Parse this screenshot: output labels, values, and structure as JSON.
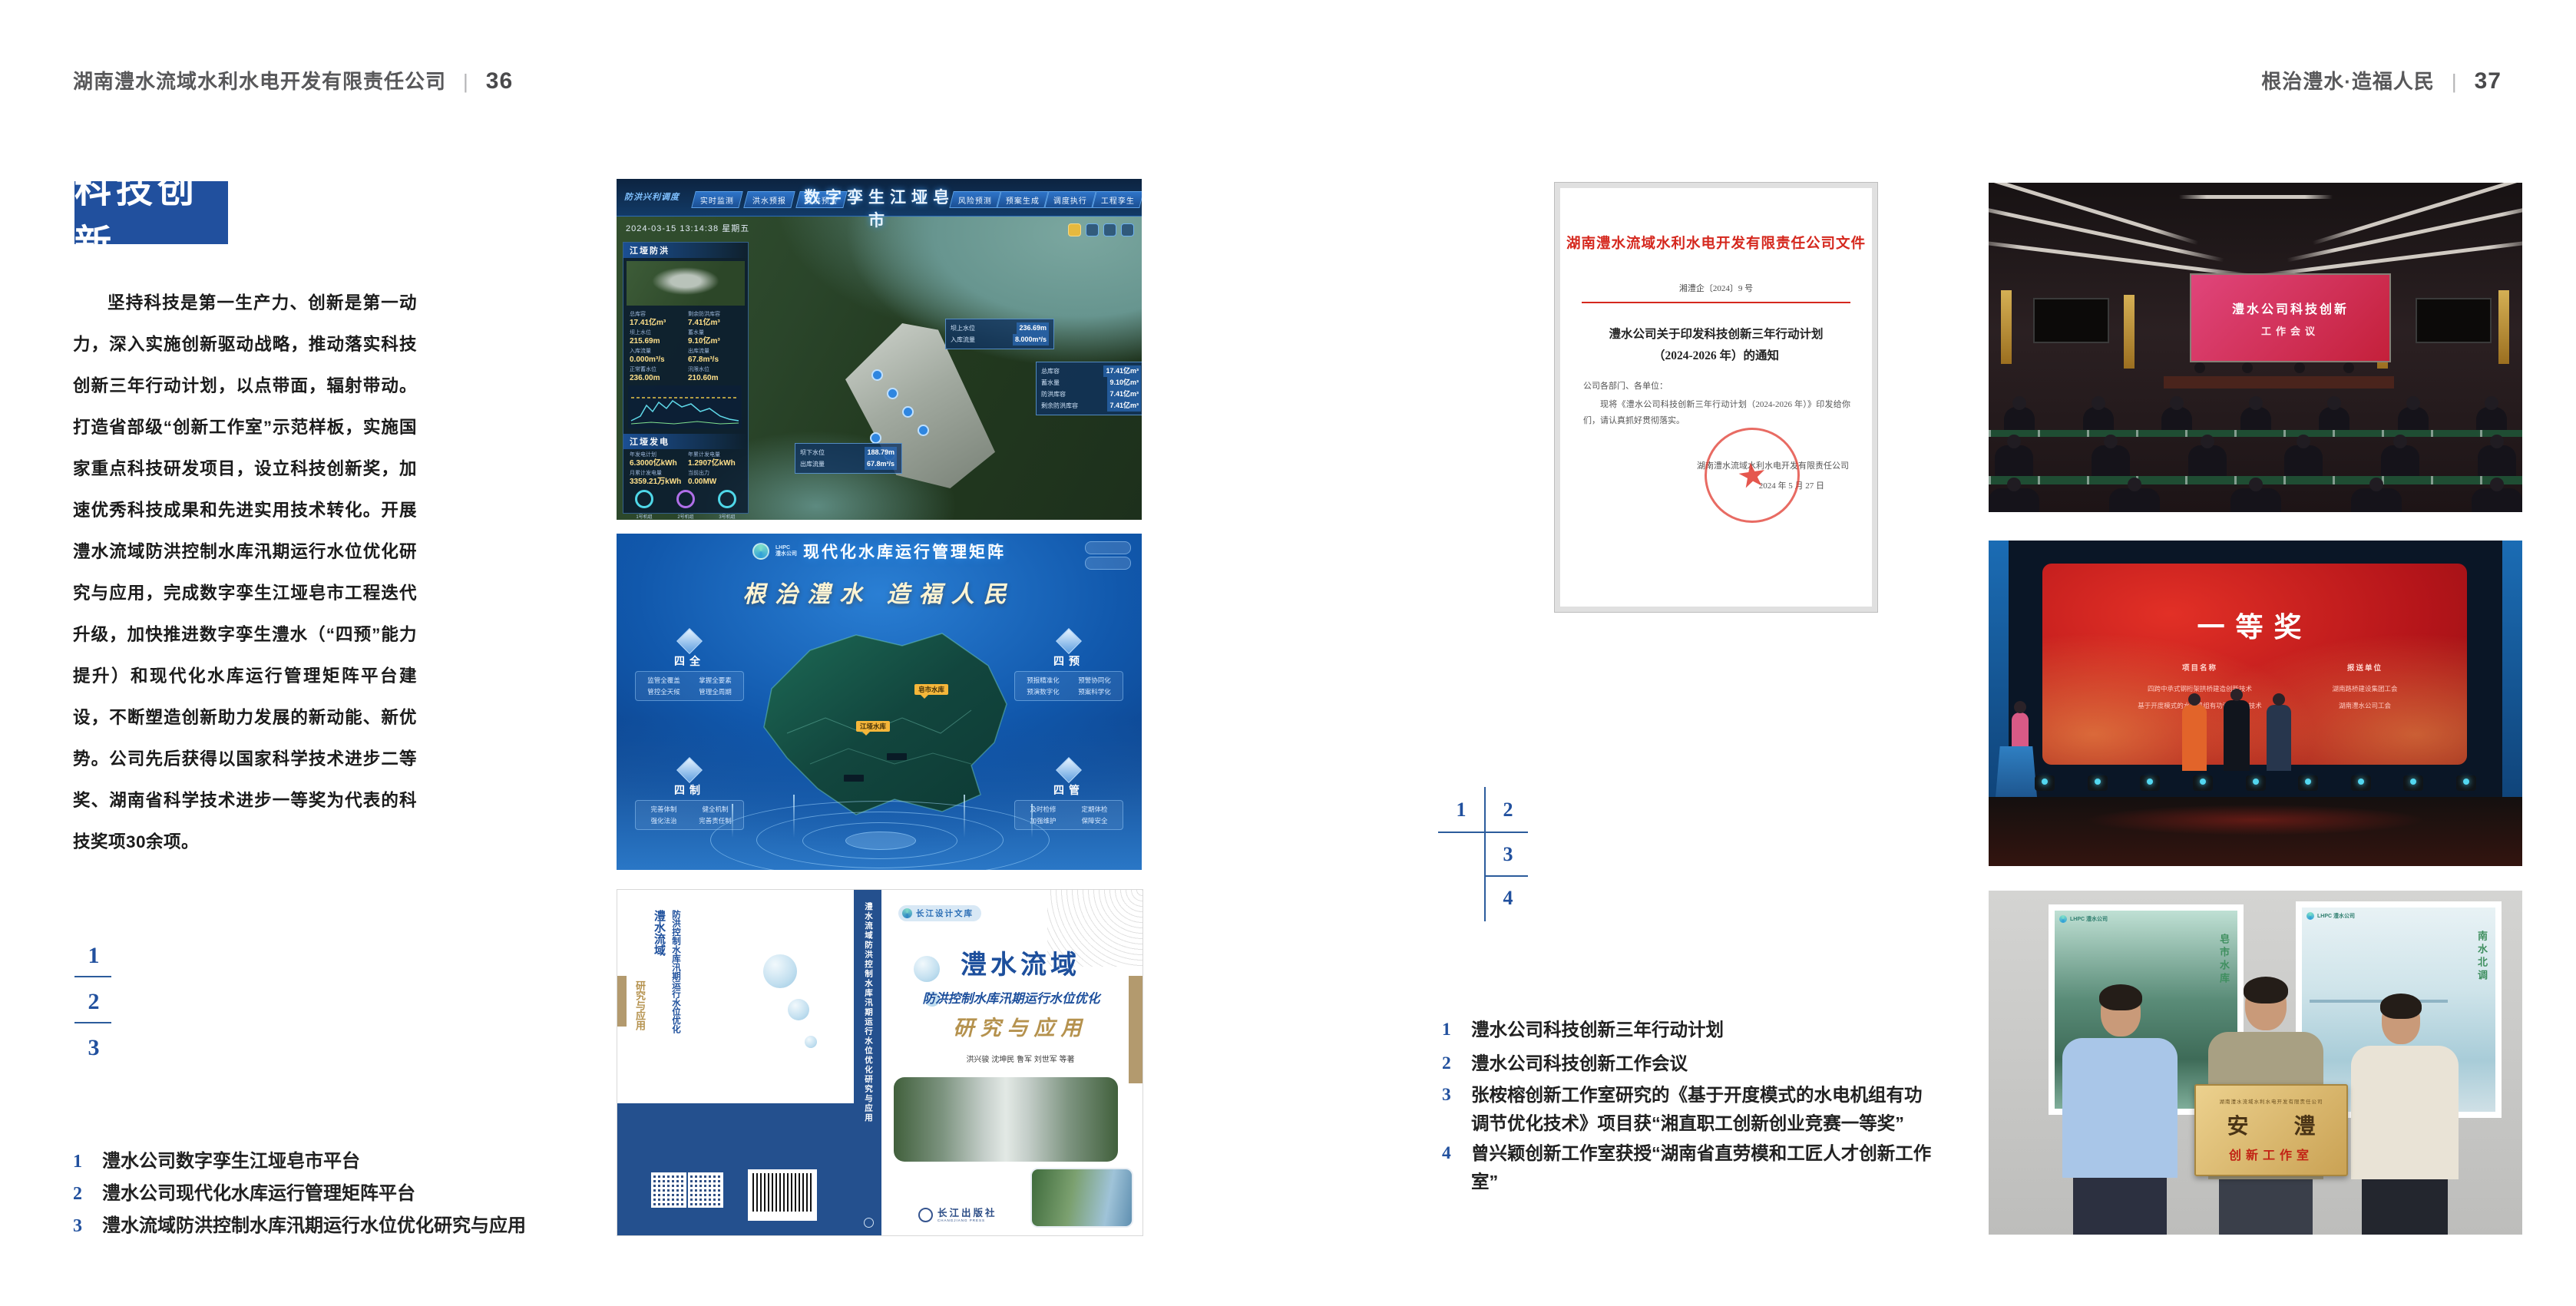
{
  "header_left": {
    "title": "湖南澧水流域水利水电开发有限责任公司",
    "divider": "|",
    "page_number": "36"
  },
  "header_right": {
    "title": "根治澧水·造福人民",
    "divider": "|",
    "page_number": "37"
  },
  "left_page": {
    "section_title": "科技创新",
    "paragraph": "坚持科技是第一生产力、创新是第一动力，深入实施创新驱动战略，推动落实科技创新三年行动计划，以点带面，辐射带动。打造省部级“创新工作室”示范样板，实施国家重点科技研发项目，设立科技创新奖，加速优秀科技成果和先进实用技术转化。开展澧水流域防洪控制水库汛期运行水位优化研究与应用，完成数字孪生江垭皂市工程迭代升级，加快推进数字孪生澧水（“四预”能力提升）和现代化水库运行管理矩阵平台建设，不断塑造创新助力发展的新动能、新优势。公司先后获得以国家科学技术进步二等奖、湖南省科学技术进步一等奖为代表的科技奖项30余项。",
    "figure_numbers": [
      "1",
      "2",
      "3"
    ],
    "captions": [
      {
        "num": "1",
        "text": "澧水公司数字孪生江垭皂市平台"
      },
      {
        "num": "2",
        "text": "澧水公司现代化水库运行管理矩阵平台"
      },
      {
        "num": "3",
        "text": "澧水流域防洪控制水库汛期运行水位优化研究与应用"
      }
    ]
  },
  "right_page": {
    "figure_numbers": [
      "1",
      "2",
      "3",
      "4"
    ],
    "captions": [
      {
        "num": "1",
        "text": "澧水公司科技创新三年行动计划"
      },
      {
        "num": "2",
        "text": "澧水公司科技创新工作会议"
      },
      {
        "num": "3",
        "text": "张桉榕创新工作室研究的《基于开度模式的水电机组有功调节优化技术》项目获“湘直职工创新创业竞赛一等奖”"
      },
      {
        "num": "4",
        "text": "曾兴颖创新工作室获授“湖南省直劳模和工匠人才创新工作室”"
      }
    ]
  },
  "fig_digital_twin": {
    "title": "数字孪生江垭皂市",
    "corner_label": "防洪兴利调度",
    "tabs_left": [
      "实时监测",
      "洪水预报",
      "防洪预警"
    ],
    "tabs_right": [
      "风险预测",
      "预案生成",
      "调度执行",
      "工程孪生"
    ],
    "timestamp": "2024-03-15 13:14:38 星期五",
    "panel_flood_title": "江垭防洪",
    "flood_stats": [
      {
        "label": "总库容",
        "value": "17.41亿m³"
      },
      {
        "label": "剩余防洪库容",
        "value": "7.41亿m³"
      },
      {
        "label": "坝上水位",
        "value": "215.69m"
      },
      {
        "label": "蓄水量",
        "value": "9.10亿m³"
      },
      {
        "label": "入库流量",
        "value": "0.000m³/s"
      },
      {
        "label": "出库流量",
        "value": "67.8m³/s"
      },
      {
        "label": "正常蓄水位",
        "value": "236.00m"
      },
      {
        "label": "汛限水位",
        "value": "210.60m"
      }
    ],
    "panel_power_title": "江垭发电",
    "power_stats": [
      {
        "label": "年发电计划",
        "value": "6.3000亿kWh"
      },
      {
        "label": "年累计发电量",
        "value": "1.2907亿kWh"
      },
      {
        "label": "月累计发电量",
        "value": "3359.21万kWh"
      },
      {
        "label": "当前出力",
        "value": "0.00MW"
      }
    ],
    "gauges": [
      "1号机组",
      "2号机组",
      "3号机组"
    ],
    "callout_upper": [
      {
        "label": "坝上水位",
        "value": "236.69m"
      },
      {
        "label": "入库流量",
        "value": "8.000m³/s"
      }
    ],
    "callout_right": [
      {
        "label": "总库容",
        "value": "17.41亿m³"
      },
      {
        "label": "蓄水量",
        "value": "9.10亿m³"
      },
      {
        "label": "防洪库容",
        "value": "7.41亿m³"
      },
      {
        "label": "剩余防洪库容",
        "value": "7.41亿m³"
      }
    ],
    "callout_lower": [
      {
        "label": "坝下水位",
        "value": "188.79m"
      },
      {
        "label": "出库流量",
        "value": "67.8m³/s"
      }
    ]
  },
  "fig_matrix": {
    "logo_text": "LHPC",
    "logo_sub": "澧水公司",
    "title": "现代化水库运行管理矩阵",
    "slogan": "根治澧水 造福人民",
    "panels": [
      {
        "title": "四全",
        "items": [
          "监管全覆盖",
          "掌握全要素",
          "管控全天候",
          "管理全周期"
        ]
      },
      {
        "title": "四预",
        "items": [
          "预报精准化",
          "预警协同化",
          "预演数字化",
          "预案科学化"
        ]
      },
      {
        "title": "四制",
        "items": [
          "完善体制",
          "健全机制",
          "强化法治",
          "完善责任制"
        ]
      },
      {
        "title": "四管",
        "items": [
          "及时检修",
          "定期体检",
          "加强维护",
          "保障安全"
        ]
      }
    ],
    "map_tags": [
      "皂市水库",
      "江垭水库"
    ]
  },
  "fig_book": {
    "series_badge": "长江设计文库",
    "title_main": "澧水流域",
    "title_sub": "防洪控制水库汛期运行水位优化",
    "title_tail": "研究与应用",
    "authors": "洪兴骏  沈坤民  鲁军  刘世军  等著",
    "spine_text": "澧水流域防洪控制水库汛期运行水位优化研究与应用",
    "publisher": "长江出版社",
    "publisher_en": "CHANGJIANG PRESS"
  },
  "fig_document": {
    "header": "湖南澧水流域水利水电开发有限责任公司文件",
    "doc_number": "湘澧企〔2024〕9 号",
    "title_line1": "澧水公司关于印发科技创新三年行动计划",
    "title_line2": "（2024-2026 年）的通知",
    "salutation": "公司各部门、各单位：",
    "body": "现将《澧水公司科技创新三年行动计划（2024-2026 年）》印发给你们，请认真抓好贯彻落实。",
    "signature": "湖南澧水流域水利水电开发有限责任公司",
    "date": "2024 年 5 月 27 日"
  },
  "fig_meeting": {
    "screen_line1": "澧水公司科技创新",
    "screen_line2": "工作会议"
  },
  "fig_award": {
    "title": "一等奖",
    "col1_header": "项目名称",
    "col1_rows": [
      "四跨中承式钢桁架拱桥建造创新技术",
      "基于开度模式的水电机组有功调节优化技术"
    ],
    "col2_header": "报送单位",
    "col2_rows": [
      "湖南路桥建设集团工会",
      "湖南澧水公司工会"
    ]
  },
  "fig_plaque": {
    "poster_left_logo": "LHPC 澧水公司",
    "poster_left_vertical": "皂市水库",
    "poster_right_logo": "LHPC 澧水公司",
    "poster_right_vertical": "南水北调",
    "plaque_header": "湖南澧水流域水利水电开发有限责任公司",
    "plaque_main": "安 澧",
    "plaque_sub": "创新工作室"
  },
  "colors": {
    "accent_blue": "#21509e",
    "document_red": "#d5281e",
    "award_red": "#c32127",
    "gold": "#d9b873"
  }
}
